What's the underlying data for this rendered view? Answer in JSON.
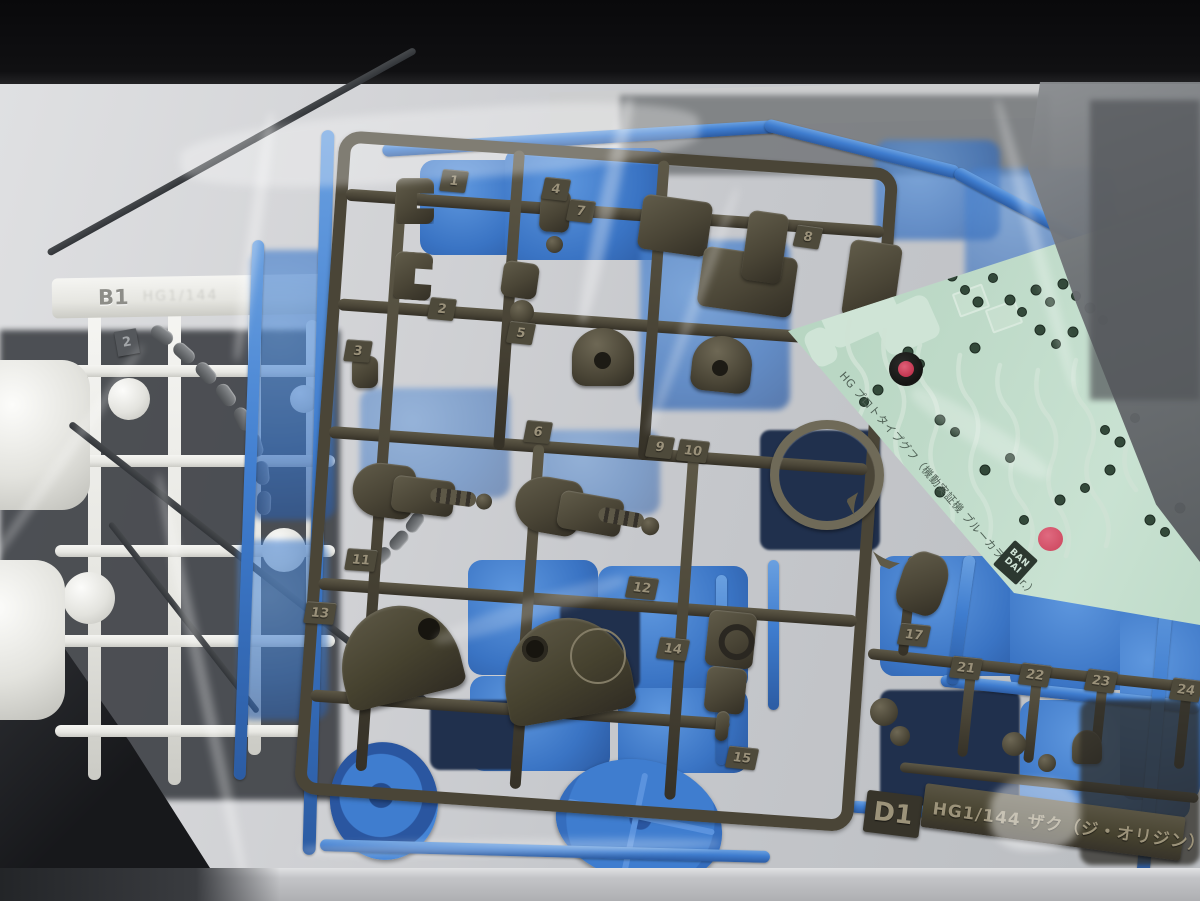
{
  "decal": {
    "title": "HG プロトタイプグフ（機動実証機 ブルーカラー Ver.）",
    "brand_line1": "BAN",
    "brand_line2": "DAI"
  },
  "plate": {
    "id": "D1",
    "text": "HG1/144 ザク（ジ・オリジン）"
  },
  "white_runner": {
    "tag": "B1",
    "molded_text": "HG1/144"
  },
  "gray_tag": "2",
  "olive_tags": [
    "1",
    "2",
    "3",
    "4",
    "5",
    "6",
    "7",
    "8",
    "9",
    "10",
    "11",
    "12",
    "13",
    "14",
    "15",
    "17",
    "21",
    "22",
    "23",
    "24"
  ],
  "colors": {
    "background_black": "#0b0b0d",
    "surface_gray": "#c6c7ca",
    "runner_blue": "#3f7dcf",
    "runner_olive": "#4a4537",
    "white_part": "#e7e7e3",
    "decal_mint": "#bedac8",
    "marking_green": "#35503c",
    "red_dot": "#d14f66"
  }
}
